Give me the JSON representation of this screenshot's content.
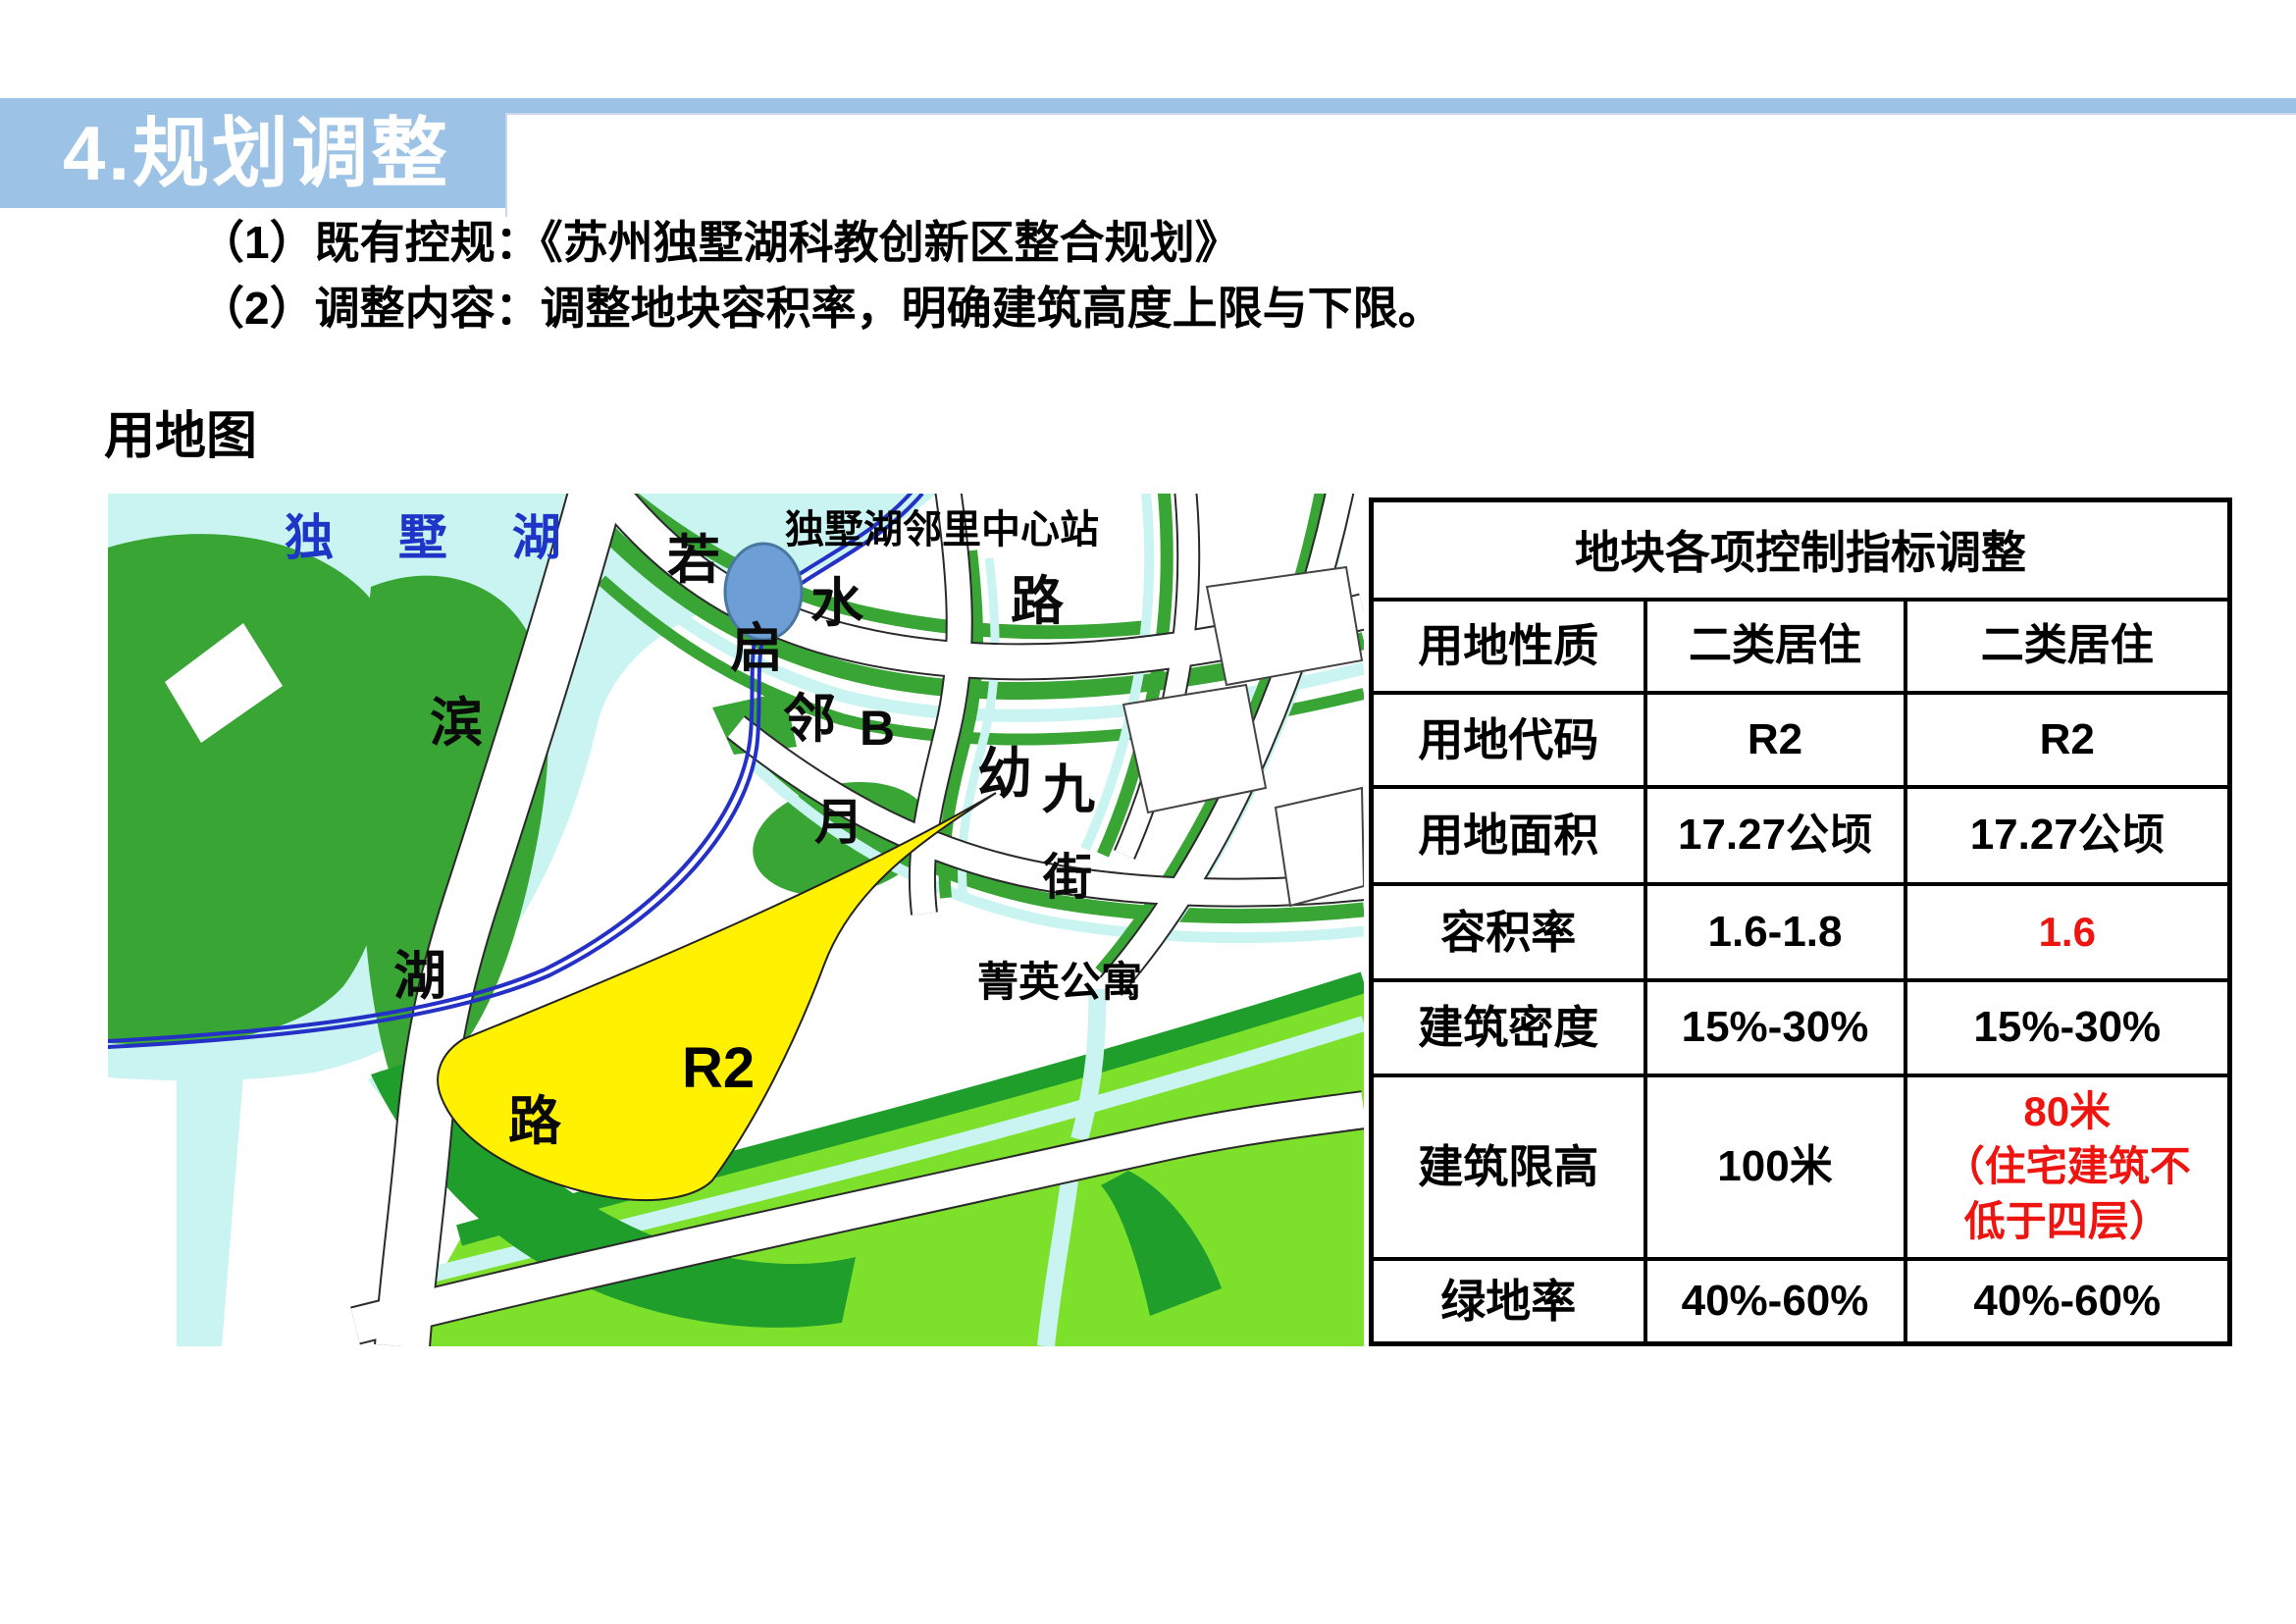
{
  "slide": {
    "section_title": "4.规划调整",
    "points": [
      "（1）既有控规：《苏州独墅湖科教创新区整合规划》",
      "（2）调整内容：调整地块容积率，明确建筑高度上限与下限。"
    ],
    "map_caption": "用地图"
  },
  "map": {
    "lake_label": "独 墅 湖",
    "station_label": "独墅湖邻里中心站",
    "plot_code": "R2",
    "apartment_label": "菁英公寓",
    "road_chars": [
      "若",
      "水",
      "路",
      "启",
      "邻",
      "B",
      "幼",
      "九",
      "月",
      "街",
      "滨",
      "湖",
      "路"
    ]
  },
  "table": {
    "title": "地块各项控制指标调整",
    "rows": [
      {
        "label": "用地性质",
        "before": "二类居住",
        "after": "二类居住",
        "after_red": false
      },
      {
        "label": "用地代码",
        "before": "R2",
        "after": "R2",
        "after_red": false
      },
      {
        "label": "用地面积",
        "before": "17.27公顷",
        "after": "17.27公顷",
        "after_red": false
      },
      {
        "label": "容积率",
        "before": "1.6-1.8",
        "after": "1.6",
        "after_red": true
      },
      {
        "label": "建筑密度",
        "before": "15%-30%",
        "after": "15%-30%",
        "after_red": false
      },
      {
        "label": "建筑限高",
        "before": "100米",
        "after": "80米\n（住宅建筑不\n低于四层）",
        "after_red": true
      },
      {
        "label": "绿地率",
        "before": "40%-60%",
        "after": "40%-60%",
        "after_red": false
      }
    ]
  },
  "colors": {
    "banner": "#9cc2e5",
    "table_red": "#ee1511",
    "lake": "#c9f4f1",
    "green": "#38a535",
    "dark_green": "#1f9e2c",
    "bright_green": "#7de12c",
    "plot_yellow": "#fff100",
    "metro_blue": "#2430c6",
    "station_blue": "#6d9ed6",
    "lake_text": "#1e36c8"
  }
}
